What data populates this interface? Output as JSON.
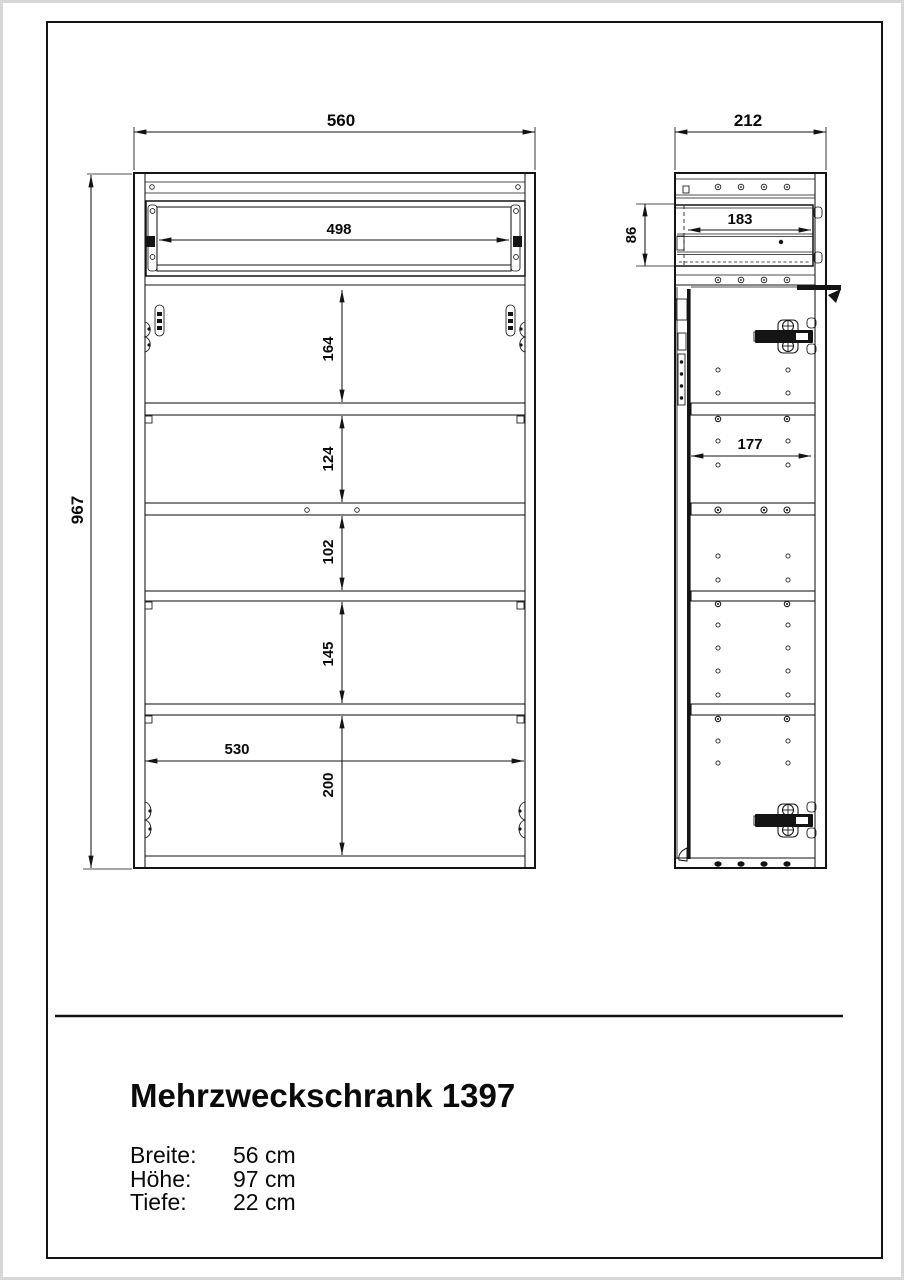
{
  "title_block": {
    "title": "Mehrzweckschrank 1397",
    "specs": [
      {
        "label": "Breite:",
        "value": "56 cm"
      },
      {
        "label": "Höhe:",
        "value": "97 cm"
      },
      {
        "label": "Tiefe:",
        "value": "22 cm"
      }
    ]
  },
  "front_view": {
    "total_width_mm": "560",
    "total_height_mm": "967",
    "drawer_opening_width_mm": "498",
    "compartment_heights_mm": [
      "164",
      "124",
      "102",
      "145",
      "200"
    ],
    "interior_width_mm": "530"
  },
  "side_view": {
    "total_depth_mm": "212",
    "drawer_inner_depth_mm": "183",
    "drawer_front_height_mm": "86",
    "shelf_depth_mm": "177"
  }
}
